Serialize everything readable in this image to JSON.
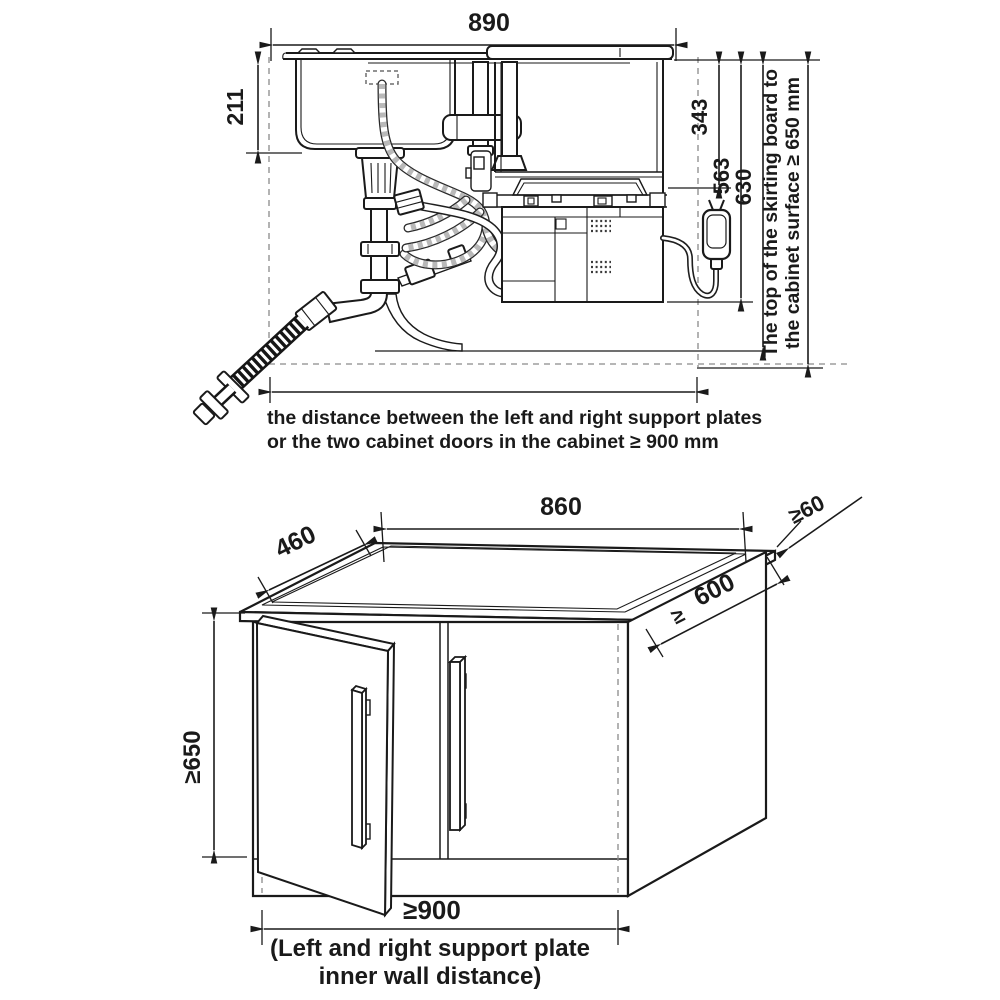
{
  "page": {
    "background": "#ffffff",
    "line_color": "#1a1a1a",
    "hose_gray": "#b9b9b9",
    "dash_gray": "#8a8a8a"
  },
  "top_diagram": {
    "dim_total_width": "890",
    "dim_sink_depth": "211",
    "dim_top_to_frame": "343",
    "dim_top_to_machine_bottom": "563",
    "dim_top_to_cabinet_floor": "630",
    "skirting_note_line1": "The top of the skirting board to",
    "skirting_note_line2": "the cabinet surface ≥ 650 mm",
    "caption_line1": "the distance between the left and right support plates",
    "caption_line2": "or the two cabinet doors in the cabinet ≥ 900 mm"
  },
  "bottom_diagram": {
    "dim_cutout_width": "860",
    "dim_cutout_depth": "460",
    "dim_edge_clearance": "≥60",
    "dim_depth_prefix": "≥",
    "dim_depth": "600",
    "dim_height": "≥650",
    "dim_inner_width": "≥900",
    "caption_line1": "(Left and right support plate",
    "caption_line2": "inner wall distance)"
  }
}
